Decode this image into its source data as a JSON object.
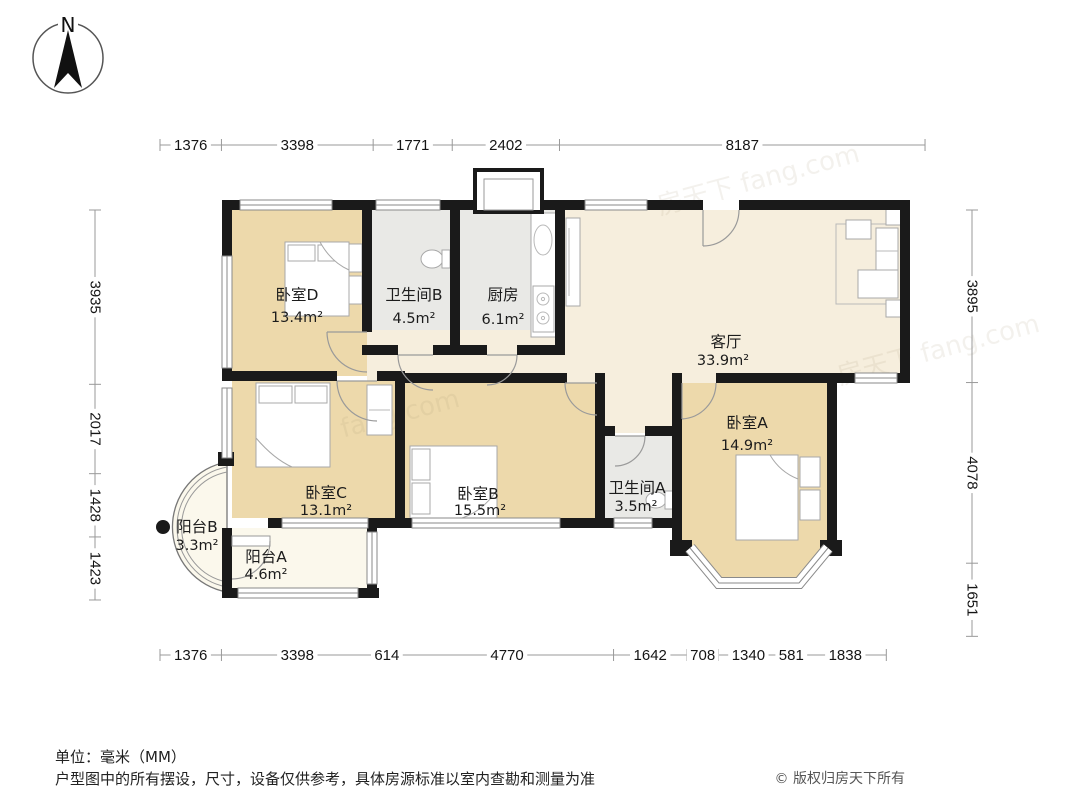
{
  "compass": {
    "label": "N"
  },
  "watermark": {
    "text": "房天下 fang.com"
  },
  "dimensions": {
    "top": [
      "1376",
      "3398",
      "1771",
      "2402",
      "8187"
    ],
    "bottom": [
      "1376",
      "3398",
      "614",
      "4770",
      "1642",
      "708",
      "1340",
      "581",
      "1838"
    ],
    "left": [
      "3935",
      "2017",
      "1428",
      "1423"
    ],
    "right": [
      "3895",
      "4078",
      "1651"
    ]
  },
  "rooms": {
    "bedroom_d": {
      "name": "卧室D",
      "area": "13.4m²"
    },
    "bath_b": {
      "name": "卫生间B",
      "area": "4.5m²"
    },
    "kitchen": {
      "name": "厨房",
      "area": "6.1m²"
    },
    "living": {
      "name": "客厅",
      "area": "33.9m²"
    },
    "bedroom_a": {
      "name": "卧室A",
      "area": "14.9m²"
    },
    "bedroom_c": {
      "name": "卧室C",
      "area": "13.1m²"
    },
    "bedroom_b": {
      "name": "卧室B",
      "area": "15.5m²"
    },
    "bath_a": {
      "name": "卫生间A",
      "area": "3.5m²"
    },
    "balcony_b": {
      "name": "阳台B",
      "area": "3.3m²"
    },
    "balcony_a": {
      "name": "阳台A",
      "area": "4.6m²"
    }
  },
  "footer": {
    "unit_label": "单位：毫米（MM）",
    "disclaimer": "户型图中的所有摆设，尺寸，设备仅供参考，具体房源标准以室内查勘和测量为准",
    "copyright": "© 版权归房天下所有"
  },
  "colors": {
    "wall": "#1a1a1a",
    "bedroom": "#edd9ab",
    "wet": "#e9e9e6",
    "living": "#f6eedd",
    "balcony": "#fbf8ec"
  }
}
